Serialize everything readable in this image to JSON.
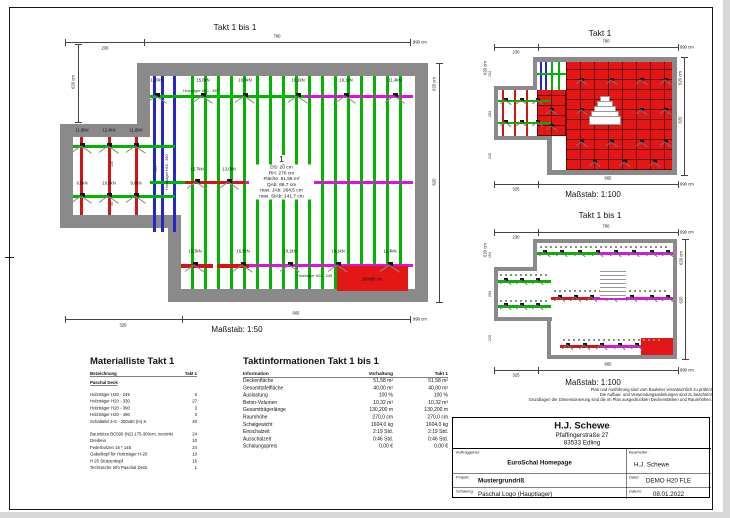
{
  "colors": {
    "green": "#00b400",
    "blue": "#2626c9",
    "red": "#d21414",
    "magenta": "#d617d6",
    "wall": "#8a8a8a",
    "hatch_red": "#e51616"
  },
  "plans": {
    "main": {
      "title": "Takt 1 bis 1",
      "scale_label": "Maßstab: 1:50",
      "dim_top": [
        "230",
        "760",
        "990 cm"
      ],
      "dim_bottom": [
        "325",
        "665",
        "990 cm"
      ],
      "dim_left": "620 cm",
      "dim_right_total": "620 cm",
      "dim_right_inner": "620",
      "info_number": "1",
      "info_lines": [
        "DS: 20 cm",
        "RH: 270 cm",
        "Fläche: 51,58 m²",
        "QAb: 66,7 cm",
        "max. JAb: 264,5 cm",
        "max. StAb: 141,7 cm"
      ],
      "loads_top": [
        "13,0kN",
        "15,0kN",
        "16,9kN",
        "19,1kN",
        "19,1kN",
        "11,4kN"
      ],
      "loads_annex_row1": [
        "11,6kN",
        "12,4kN",
        "11,6kN"
      ],
      "loads_annex_row2": [
        "9,6kN",
        "10,0kN",
        "9,6kN"
      ],
      "loads_mid": [
        "15,7kN",
        "13,0kN"
      ],
      "loads_bottom": [
        "15,3kN",
        "16,9kN",
        "19,1kN",
        "19,1kN",
        "11,4kN"
      ],
      "beam_label_h330": "Holzträger H20 - 330",
      "beam_label_h390": "Holzträger H20 - 390",
      "beam_label_h245": "Holzträger H20 - 245",
      "panel_label": "200x50 cm",
      "small_dim_notch": "154",
      "small_dim_annex_upper": "155",
      "small_dim_annex_lower": "90"
    },
    "takt1": {
      "title": "Takt 1",
      "scale_label": "Maßstab: 1:100",
      "dim_top": [
        "230",
        "760",
        "990 cm"
      ],
      "dim_bottom": [
        "325",
        "665",
        "990 cm"
      ],
      "dim_left_total": "620 cm",
      "dim_left_parts": [
        "154",
        "283",
        "220"
      ],
      "dim_right_total": "620 cm",
      "dim_right_inner": "620"
    },
    "overview": {
      "title": "Takt 1 bis 1",
      "scale_label": "Maßstab: 1:100",
      "dim_top": [
        "230",
        "760",
        "990 cm"
      ],
      "dim_bottom": [
        "325",
        "665",
        "990 cm"
      ],
      "dim_left_total": "620 cm",
      "dim_left_parts": [
        "154",
        "283",
        "220"
      ],
      "dim_right_total": "620 cm",
      "dim_right_inner": "620"
    }
  },
  "disclaimer": [
    "Plan und Ausführung sind vom Bauleiter verantwortlich zu prüfen!",
    "Die Aufbau- und Verwendungsanleitungen sind zu beachten!",
    "Grundlagen der Dimensionierung sind die im Plan ausgedruckten Deckenstärken und Raumhöhen."
  ],
  "material_list": {
    "title": "Materialliste  Takt 1",
    "col_name": "Bezeichnung",
    "col_qty": "Takt 1",
    "group": "Paschal Deck",
    "items_a": [
      {
        "name": "Holzträger H20 - 245",
        "qty": "6"
      },
      {
        "name": "Holzträger H20 - 330",
        "qty": "27"
      },
      {
        "name": "Holzträger H20 - 390",
        "qty": "3"
      },
      {
        "name": "Holzträger H20 - 490",
        "qty": "3"
      },
      {
        "name": "Schaltafel 3-S - 200x50 (m) K",
        "qty": "40"
      }
    ],
    "items_b": [
      {
        "name": "Baustütze BC500 (N2) 175-300cm, verzinkt",
        "qty": "24"
      },
      {
        "name": "Dreibein",
        "qty": "10"
      },
      {
        "name": "Federbolzen 16 * 145",
        "qty": "24"
      },
      {
        "name": "Gabelkopf für Holzträger H-20",
        "qty": "10"
      },
      {
        "name": "H 20 Stützenkopf",
        "qty": "16"
      },
      {
        "name": "Technische Info Paschal Deck",
        "qty": "1"
      }
    ]
  },
  "takt_info": {
    "title": "Taktinformationen  Takt 1 bis 1",
    "headers": [
      "Information",
      "Vorhaltung",
      "Takt 1"
    ],
    "rows": [
      [
        "Deckenfläche",
        "51,58 m²",
        "51,58 m²"
      ],
      [
        "Gesamttafelfläche",
        "40,00 m²",
        "40,00 m²"
      ],
      [
        "Auslastung",
        "100 %",
        "100 %"
      ],
      [
        "Beton-Volumen",
        "10,32 m³",
        "10,32 m³"
      ],
      [
        "Gesamtträgerlänge",
        "130,200 m",
        "130,200 m"
      ],
      [
        "Raumhöhe",
        "270,0 cm",
        "270,0 cm"
      ],
      [
        "Schalgewicht",
        "1604,0 kg",
        "1604,0 kg"
      ],
      [
        "Einschalzeit",
        "2:19 Std.",
        "2:19 Std."
      ],
      [
        "Ausschalzeit",
        "0:46 Std.",
        "0:46 Std."
      ],
      [
        "Schalungspreis",
        "0,00 €",
        "0,00 €"
      ]
    ]
  },
  "title_block": {
    "company": "H.J. Schewe",
    "street": "Pfaffingerstraße 27",
    "city": "83533 Edling",
    "fields": [
      {
        "label": "Auftraggeber:",
        "value": "EuroSchal Homepage"
      },
      {
        "label": "Bearbeiter:",
        "value": "H.J. Schewe"
      },
      {
        "label": "Projekt:",
        "value": "Mustergrundriß"
      },
      {
        "label": "Datei:",
        "value": "DEMO H20 FLE"
      },
      {
        "label": "Schalung:",
        "value": "Paschal Logo (Hauptlager)"
      },
      {
        "label": "Datum:",
        "value": "08.01.2022"
      }
    ]
  }
}
